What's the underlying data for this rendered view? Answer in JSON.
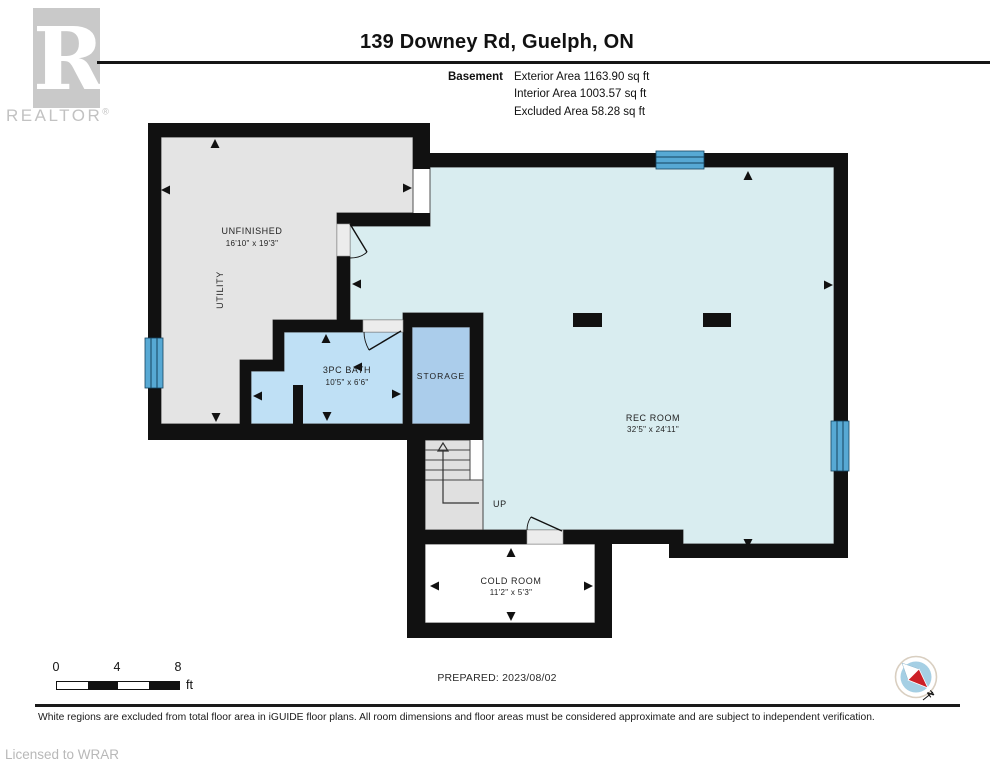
{
  "header": {
    "logo_letter": "R",
    "logo_label": "REALTOR",
    "logo_registered": "®",
    "title": "139 Downey Rd, Guelph, ON",
    "floor_label": "Basement",
    "area_lines": [
      "Exterior Area 1163.90 sq ft",
      "Interior Area 1003.57 sq ft",
      "Excluded Area 58.28 sq ft"
    ]
  },
  "floorplan": {
    "rooms": {
      "unfinished": {
        "name": "UNFINISHED",
        "dims": "16'10\" x 19'3\""
      },
      "utility": {
        "name": "UTILITY"
      },
      "bath": {
        "name": "3PC BATH",
        "dims": "10'5\" x 6'6\""
      },
      "storage": {
        "name": "STORAGE"
      },
      "rec": {
        "name": "REC ROOM",
        "dims": "32'5\" x 24'11\""
      },
      "cold": {
        "name": "COLD ROOM",
        "dims": "11'2\" x 5'3\""
      }
    },
    "stairs_label": "UP",
    "colors": {
      "wall": "#111111",
      "unfinished_fill": "#e4e4e4",
      "rec_fill": "#d9edf0",
      "bath_fill": "#bfe0f5",
      "storage_fill": "#abcdeb",
      "window": "#57a9d4",
      "stairs_fill": "#e0e0e0"
    }
  },
  "footer": {
    "scale_ticks": [
      "0",
      "4",
      "8"
    ],
    "scale_unit": "ft",
    "prepared": "PREPARED: 2023/08/02",
    "compass_label": "N",
    "disclaimer": "White regions are excluded from total floor area in iGUIDE floor plans. All room dimensions and floor areas must be considered approximate and are subject to independent verification.",
    "license": "Licensed to WRAR"
  }
}
